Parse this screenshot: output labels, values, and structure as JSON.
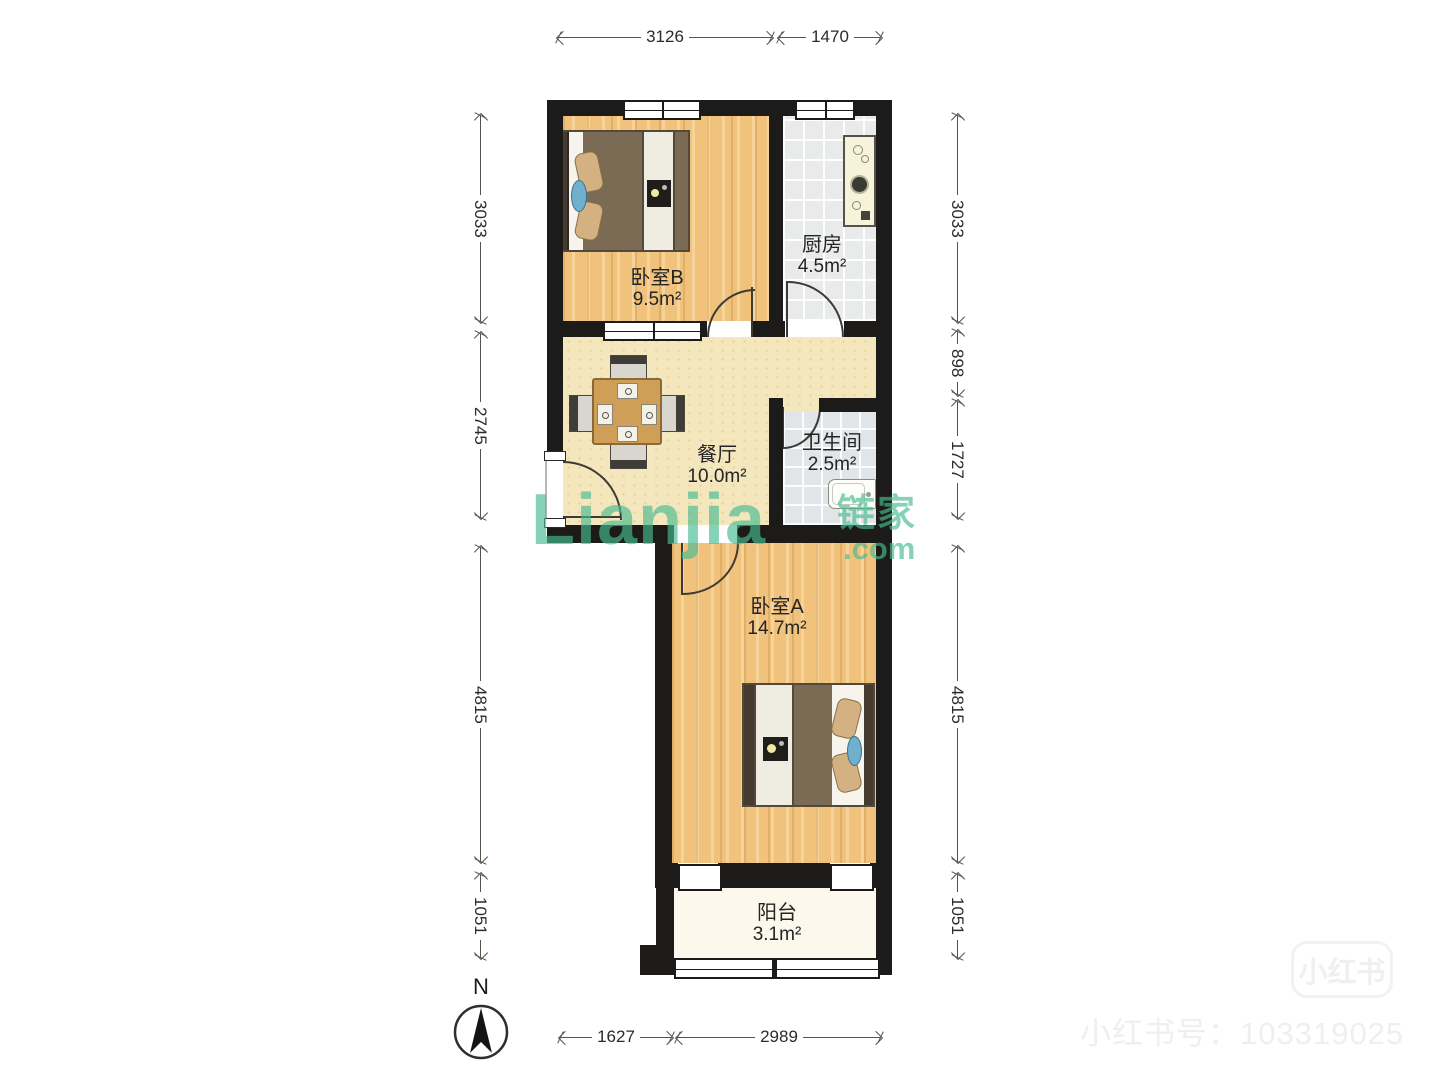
{
  "plan": {
    "rooms": {
      "bedroom_b": {
        "name": "卧室B",
        "area": "9.5m²"
      },
      "kitchen": {
        "name": "厨房",
        "area": "4.5m²"
      },
      "dining": {
        "name": "餐厅",
        "area": "10.0m²"
      },
      "bathroom": {
        "name": "卫生间",
        "area": "2.5m²"
      },
      "bedroom_a": {
        "name": "卧室A",
        "area": "14.7m²"
      },
      "balcony": {
        "name": "阳台",
        "area": "3.1m²"
      }
    },
    "dims": {
      "top": [
        "3126",
        "1470"
      ],
      "left": [
        "3033",
        "2745",
        "4815",
        "1051"
      ],
      "right": [
        "3033",
        "898",
        "1727",
        "4815",
        "1051"
      ],
      "bottom": [
        "1627",
        "2989"
      ]
    },
    "compass": {
      "north_label": "N"
    }
  },
  "watermark": {
    "logo": "Lianjia",
    "cn": "链家",
    "com": ".com"
  },
  "branding": {
    "xiaohongshu_badge": "小红书",
    "xiaohongshu_id": "小红书号：103319025"
  },
  "colors": {
    "wall": "#1d1b19",
    "wood_floor": "#f0c27c",
    "dining_floor": "#f5e7bd",
    "tile_floor": "#e9ebea",
    "balcony_floor": "#fcf9ec",
    "watermark_green": "#48ba91"
  }
}
